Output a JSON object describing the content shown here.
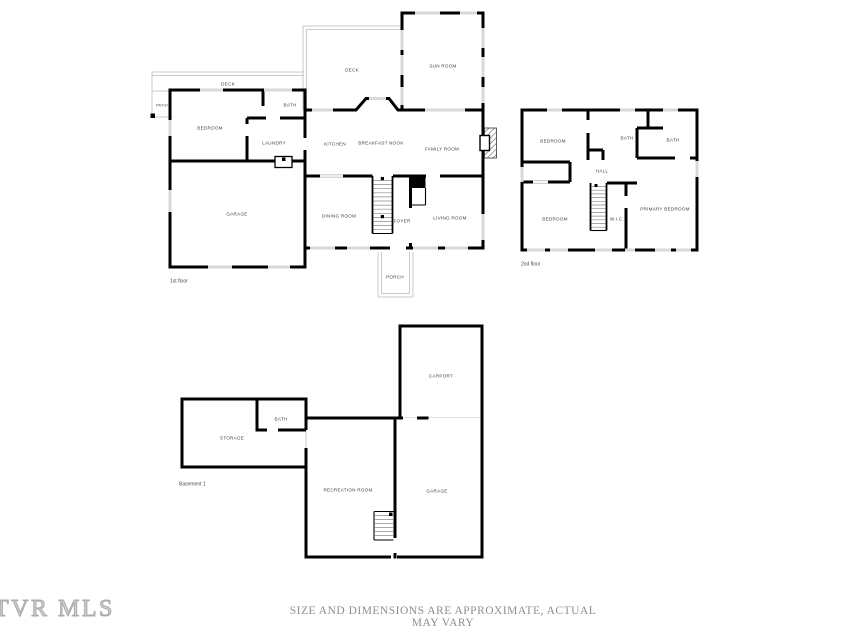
{
  "watermark": "TVR MLS",
  "disclaimer": "SIZE AND DIMENSIONS ARE APPROXIMATE, ACTUAL MAY VARY",
  "floors": {
    "first": {
      "caption": "1st floor",
      "rooms": {
        "deck_upper": "DECK",
        "sun_room": "SUN ROOM",
        "deck_side": "DECK",
        "patio": "PATIO",
        "bedroom": "BEDROOM",
        "bath": "BATH",
        "laundry": "LAUNDRY",
        "kitchen": "KITCHEN",
        "breakfast_nook": "BREAKFAST NOOK",
        "family_room": "FAMILY ROOM",
        "garage": "GARAGE",
        "dining_room": "DINING ROOM",
        "foyer": "FOYER",
        "living_room": "LIVING ROOM",
        "porch": "PORCH"
      }
    },
    "second": {
      "caption": "2nd floor",
      "rooms": {
        "bedroom_top": "BEDROOM",
        "bath_middle": "BATH",
        "bath_right": "BATH",
        "hall": "HALL",
        "bedroom_bottom": "BEDROOM",
        "wic": "W.I.C.",
        "primary_bedroom": "PRIMARY BEDROOM"
      }
    },
    "basement": {
      "caption": "Basement 1",
      "rooms": {
        "carport": "CARPORT",
        "bath": "BATH",
        "storage": "STORAGE",
        "recreation_room": "RECREATION ROOM",
        "garage": "GARAGE"
      }
    }
  },
  "colors": {
    "wall": "#000000",
    "window": "#d8d8d8",
    "outdoor_line": "#c9c9c9",
    "room_label": "#3f3f3f",
    "footer_text": "#8e8e8e",
    "watermark": "#cfcfcf"
  }
}
